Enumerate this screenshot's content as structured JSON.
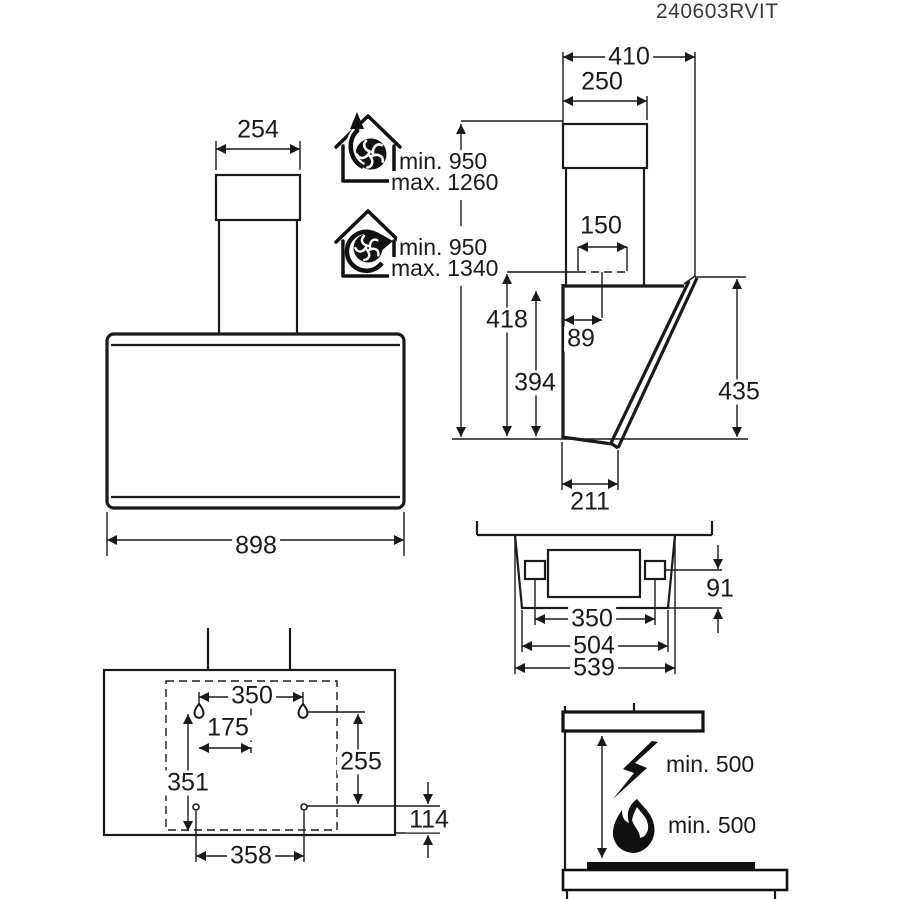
{
  "doc": {
    "code": "240603RVIT"
  },
  "front_view": {
    "chimney_width_mm": "254",
    "body_width_mm": "898"
  },
  "installation_heights": {
    "exhaust_min": "min. 950",
    "exhaust_max": "max. 1260",
    "recirculation_min": "min. 950",
    "recirculation_max": "max. 1340"
  },
  "side_view": {
    "total_depth_mm": "410",
    "chimney_depth_mm": "250",
    "duct_width_mm": "150",
    "duct_offset_mm": "89",
    "height_to_duct_mm": "418",
    "rear_height_mm": "394",
    "front_height_mm": "435",
    "bottom_depth_mm": "211"
  },
  "top_view": {
    "bracket_drop_mm": "91",
    "bracket_spacing_mm": "350",
    "rear_width_mm": "504",
    "front_width_mm": "539"
  },
  "mounting_template": {
    "upper_hole_spacing_mm": "350",
    "half_spacing_mm": "175",
    "vertical_spacing_mm": "351",
    "right_vertical_mm": "255",
    "bottom_offset_mm": "114",
    "lower_hole_spacing_mm": "358"
  },
  "clearances": {
    "electric_hob": "min. 500",
    "gas_hob": "min. 500"
  }
}
